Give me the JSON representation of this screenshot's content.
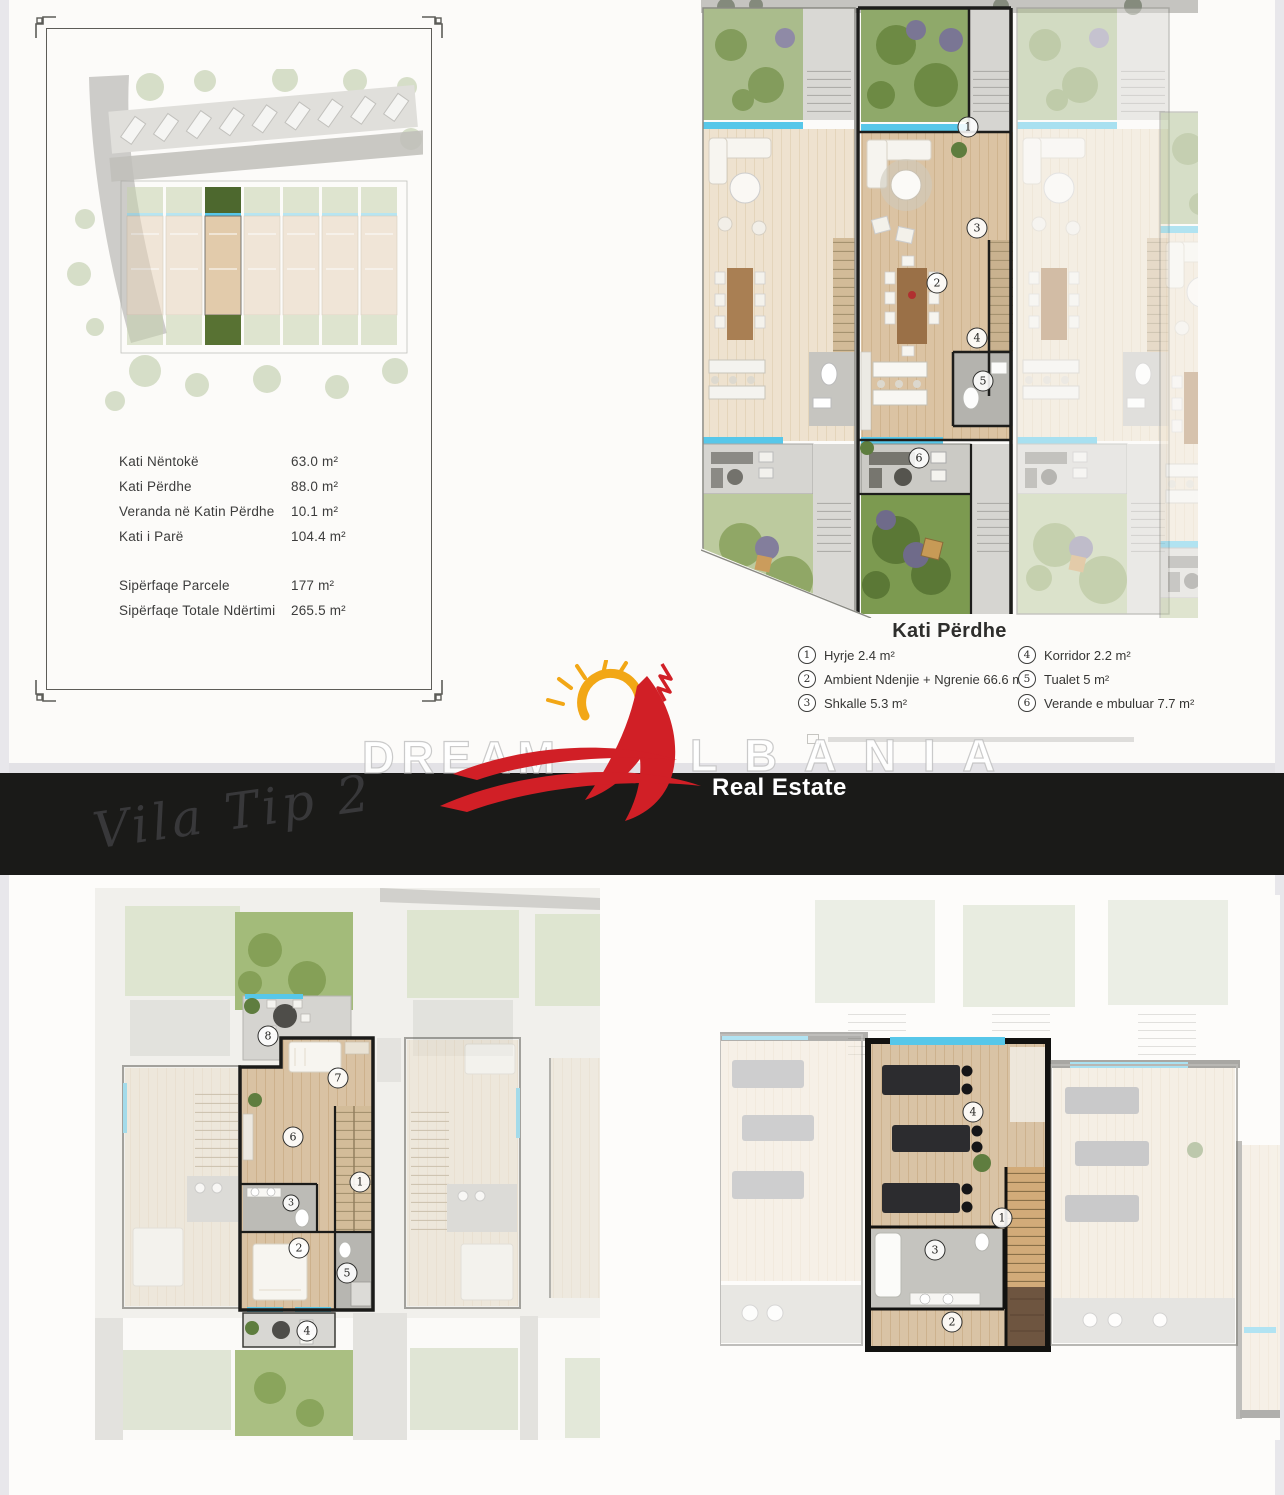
{
  "meta": {
    "script_title": "Vila Tip 2",
    "brand_left": "DREAM",
    "brand_right": "LBANIA",
    "brand_full": "DREAM ALBANIA",
    "tagline": "Real Estate"
  },
  "areas_table": {
    "rows": [
      {
        "label": "Kati Nëntokë",
        "value": "63.0 m²"
      },
      {
        "label": "Kati Përdhe",
        "value": "88.0 m²"
      },
      {
        "label": "Veranda në Katin Përdhe",
        "value": "10.1 m²"
      },
      {
        "label": "Kati i Parë",
        "value": "104.4 m²"
      }
    ],
    "totals": [
      {
        "label": "Sipërfaqe Parcele",
        "value": "177 m²"
      },
      {
        "label": "Sipërfaqe Totale Ndërtimi",
        "value": "265.5 m²"
      }
    ]
  },
  "ground_floor": {
    "title": "Kati Përdhe",
    "legend": [
      {
        "num": "1",
        "label": "Hyrje 2.4 m²"
      },
      {
        "num": "2",
        "label": "Ambient Ndenjie + Ngrenie 66.6 m²"
      },
      {
        "num": "3",
        "label": "Shkalle 5.3 m²"
      },
      {
        "num": "4",
        "label": "Korridor 2.2 m²"
      },
      {
        "num": "5",
        "label": "Tualet 5 m²"
      },
      {
        "num": "6",
        "label": "Verande e mbuluar 7.7 m²"
      }
    ],
    "plan_markers": [
      "1",
      "2",
      "3",
      "4",
      "5",
      "6"
    ]
  },
  "first_floor": {
    "plan_markers": [
      "1",
      "2",
      "3",
      "4",
      "5",
      "6",
      "7",
      "8"
    ]
  },
  "basement": {
    "plan_markers": [
      "1",
      "2",
      "3",
      "4"
    ]
  },
  "colors": {
    "accent_red": "#d11f26",
    "sun_yellow": "#f2a716",
    "banner_black": "#1a1a18",
    "window_blue": "#57c7e9",
    "floor_tan": "#dbc3a3",
    "garden_green": "#7c9a50"
  }
}
